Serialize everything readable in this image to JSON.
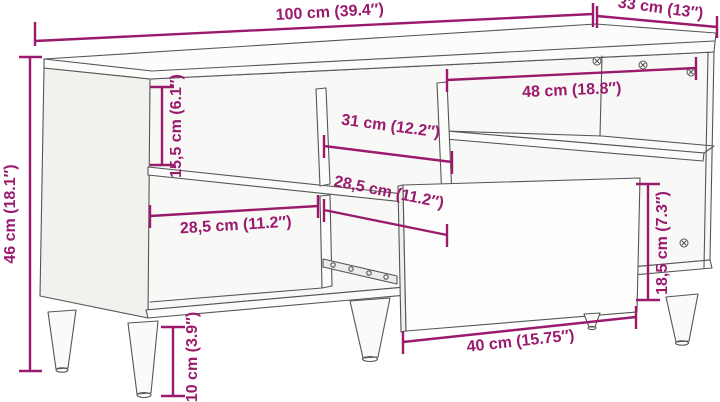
{
  "diagram": {
    "kind": "furniture-dimension-diagram",
    "subject": "TV cabinet with open compartments, tapered legs and pulled-out drawer",
    "dimension_color": "#9A1A6E",
    "line_color": "#565656",
    "dimensions": {
      "overall_width": "100 cm (39.4″)",
      "overall_depth": "33 cm (13″)",
      "overall_height": "46 cm (18.1″)",
      "upper_compartment_height": "15,5 cm (6.1″)",
      "middle_compartment_width": "31 cm (12.2″)",
      "right_compartment_width": "48 cm (18.8″)",
      "lower_left_compartment_width": "28,5 cm (11.2″)",
      "drawer_bay_depth": "28,5 cm (11.2″)",
      "drawer_front_height": "18,5 cm (7.3″)",
      "drawer_front_width": "40 cm (15.75″)",
      "leg_height": "10 cm (3.9″)"
    }
  }
}
